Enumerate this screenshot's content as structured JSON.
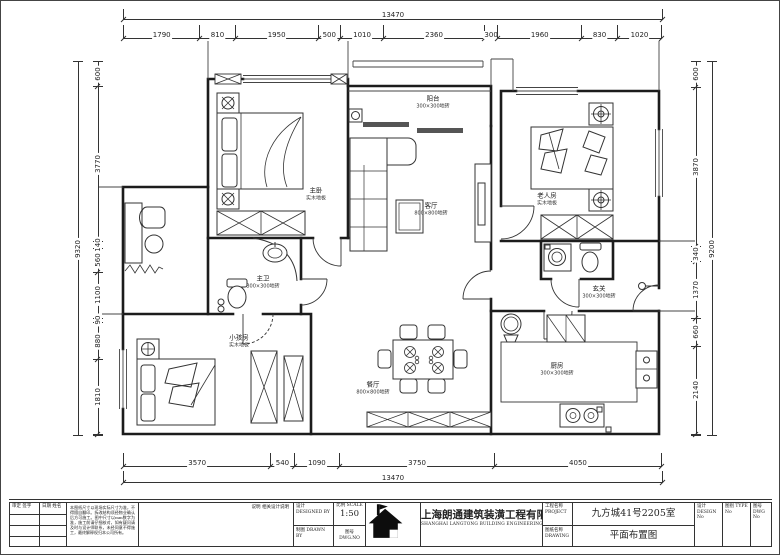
{
  "dims": {
    "top_total": "13470",
    "top": [
      "1790",
      "810",
      "1950",
      "500",
      "1010",
      "2360",
      "300",
      "1960",
      "830",
      "1020"
    ],
    "bottom": [
      "3570",
      "540",
      "1090",
      "3750",
      "4050"
    ],
    "bottom_total": "13470",
    "left_total": "9320",
    "left": [
      "600",
      "3770",
      "140",
      "560",
      "1100",
      "90",
      "880",
      "1810"
    ],
    "right_total": "9200",
    "right": [
      "600",
      "3870",
      "340",
      "1370",
      "660",
      "2140"
    ]
  },
  "plan": {
    "rooms": [
      {
        "name": "主卧",
        "floor": "实木地板"
      },
      {
        "name": "阳台",
        "floor": "300×300地砖"
      },
      {
        "name": "客厅",
        "floor": "800×800地砖"
      },
      {
        "name": "老人房",
        "floor": "实木地板"
      },
      {
        "name": "主卫",
        "floor": "300×300地砖"
      },
      {
        "name": "小孩房",
        "floor": "实木地板"
      },
      {
        "name": "餐厅",
        "floor": "800×800地砖"
      },
      {
        "name": "厨房",
        "floor": "300×300地砖"
      },
      {
        "name": "玄关",
        "floor": "300×300地砖"
      }
    ]
  },
  "titleblock": {
    "sign_col": "审定 签字",
    "date_col": "日期 姓名",
    "notes": "本图纸尺寸以现场实际尺寸为准，不得擅自翻印。拆改结构须经物业确认后方可施工。图中尺寸以mm数字为准，施工前请仔细核对，如有疑问请及时与设计师联系，未经同意不得施工，最终解释权归本公司所有。",
    "desc_label": "说明",
    "desc_value": "相关设计说明",
    "row_design": "设计 DESIGNED BY",
    "row_draw": "制图 DRAWN BY",
    "scale_label": "比例 SCALE",
    "scale_value": "1:50",
    "no_label": "图号 DWG.NO",
    "company_cn": "上海朗通建筑装潢工程有限公司",
    "company_en": "SHANGHAI LANGTONG BUILDING ENGINEERING CO.,LTD",
    "project_label": "工程名称 PROJECT",
    "drawing_label": "图纸名称 DRAWING",
    "project_name": "九方城41号2205室",
    "drawing_name": "平面布置图",
    "tail_design": "设计 DESIGN No",
    "tail_type": "图别 TYPE No",
    "tail_no": "图号 DWG No"
  }
}
